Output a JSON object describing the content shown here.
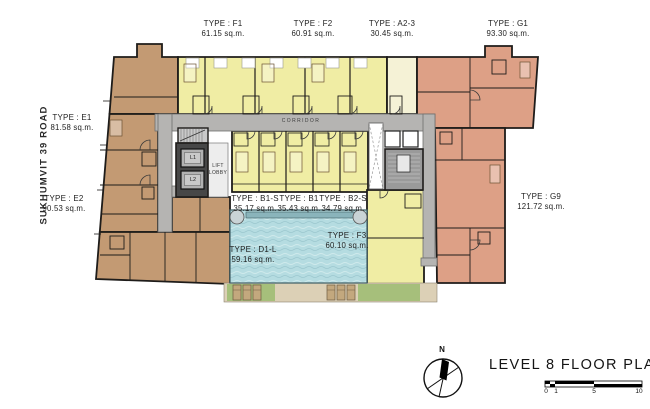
{
  "title": "LEVEL 8 FLOOR PLAN",
  "road_label": "SUKHUMVIT 39 ROAD",
  "compass": {
    "north_label": "N"
  },
  "corridor_label": "CORRIDOR",
  "core": {
    "lift_lobby_line1": "LIFT",
    "lift_lobby_line2": "LOBBY",
    "lift_1": "L1",
    "lift_2": "L2"
  },
  "scale_bar": {
    "ticks": [
      "0",
      "1",
      "5",
      "10"
    ]
  },
  "units": [
    {
      "id": "f1",
      "type": "TYPE : F1",
      "area": "61.15 sq.m."
    },
    {
      "id": "f2",
      "type": "TYPE : F2",
      "area": "60.91 sq.m."
    },
    {
      "id": "a2-3",
      "type": "TYPE : A2-3",
      "area": "30.45 sq.m."
    },
    {
      "id": "g1",
      "type": "TYPE : G1",
      "area": "93.30 sq.m."
    },
    {
      "id": "e1",
      "type": "TYPE : E1",
      "area": "81.58 sq.m."
    },
    {
      "id": "e2",
      "type": "TYPE : E2",
      "area": "90.53 sq.m."
    },
    {
      "id": "g9",
      "type": "TYPE : G9",
      "area": "121.72 sq.m."
    },
    {
      "id": "b1-s",
      "type": "TYPE : B1-S",
      "area": "35.17 sq.m."
    },
    {
      "id": "b1",
      "type": "TYPE : B1",
      "area": "35.43 sq.m."
    },
    {
      "id": "b2-s",
      "type": "TYPE : B2-S",
      "area": "34.79 sq.m."
    },
    {
      "id": "f3",
      "type": "TYPE : F3",
      "area": "60.10 sq.m."
    },
    {
      "id": "d1-l",
      "type": "TYPE : D1-L",
      "area": "59.16 sq.m."
    }
  ],
  "colors": {
    "page-bg": "#ffffff",
    "unit-brown": "#c39a73",
    "unit-yellow": "#f0eda4",
    "unit-cream": "#f5f2d6",
    "unit-salmon": "#dda086",
    "corridor-gray": "#b5b4b2",
    "core-dark": "#474747",
    "stair-gray": "#c9c9c9",
    "stair-gray-dark": "#9a9a9a",
    "lift-gray": "#b2b2b2",
    "lobby-gray": "#ededed",
    "pool-blue": "#b5dce1",
    "pool-edge": "#8ab4bb",
    "deck-tan": "#dcd0b6",
    "deck-green": "#a6bf7b",
    "lounger-tan": "#c3a87e",
    "wall-dark": "#1e1c1a",
    "text-dark": "#1f1f1f"
  }
}
